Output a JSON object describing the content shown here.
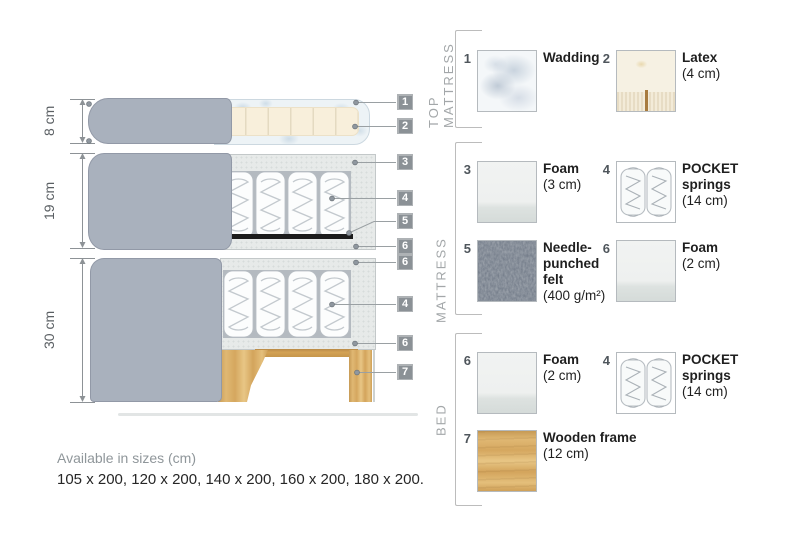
{
  "diagram": {
    "dimensions": [
      {
        "label": "8 cm"
      },
      {
        "label": "19 cm"
      },
      {
        "label": "30 cm"
      }
    ],
    "tags": [
      "1",
      "2",
      "3",
      "4",
      "5",
      "6",
      "6",
      "4",
      "6",
      "7"
    ]
  },
  "legend": {
    "sections": [
      {
        "label": "TOP MATTRESS",
        "items": [
          {
            "num": "1",
            "name": "Wadding",
            "size": ""
          },
          {
            "num": "2",
            "name": "Latex",
            "size": "(4 cm)"
          }
        ]
      },
      {
        "label": "MATTRESS",
        "items": [
          {
            "num": "3",
            "name": "Foam",
            "size": "(3 cm)"
          },
          {
            "num": "4",
            "name": "POCKET\nsprings",
            "size": "(14 cm)"
          },
          {
            "num": "5",
            "name": "Needle-\npunched\nfelt",
            "size": "(400 g/m²)"
          },
          {
            "num": "6",
            "name": "Foam",
            "size": "(2 cm)"
          }
        ]
      },
      {
        "label": "BED",
        "items": [
          {
            "num": "6",
            "name": "Foam",
            "size": "(2 cm)"
          },
          {
            "num": "4",
            "name": "POCKET\nsprings",
            "size": "(14 cm)"
          },
          {
            "num": "7",
            "name": "Wooden frame",
            "size": "(12 cm)"
          }
        ]
      }
    ]
  },
  "footer": {
    "line1": "Available in sizes (cm)",
    "line2": "105 x 200, 120 x 200, 140 x 200, 160 x 200, 180 x 200."
  },
  "colors": {
    "fabric": "#a9b1bd",
    "foam": "#e7eae9",
    "latex": "#f8efdb",
    "wood": "#ddb26b",
    "felt": "#6e7681",
    "tag": "#8b9196"
  }
}
